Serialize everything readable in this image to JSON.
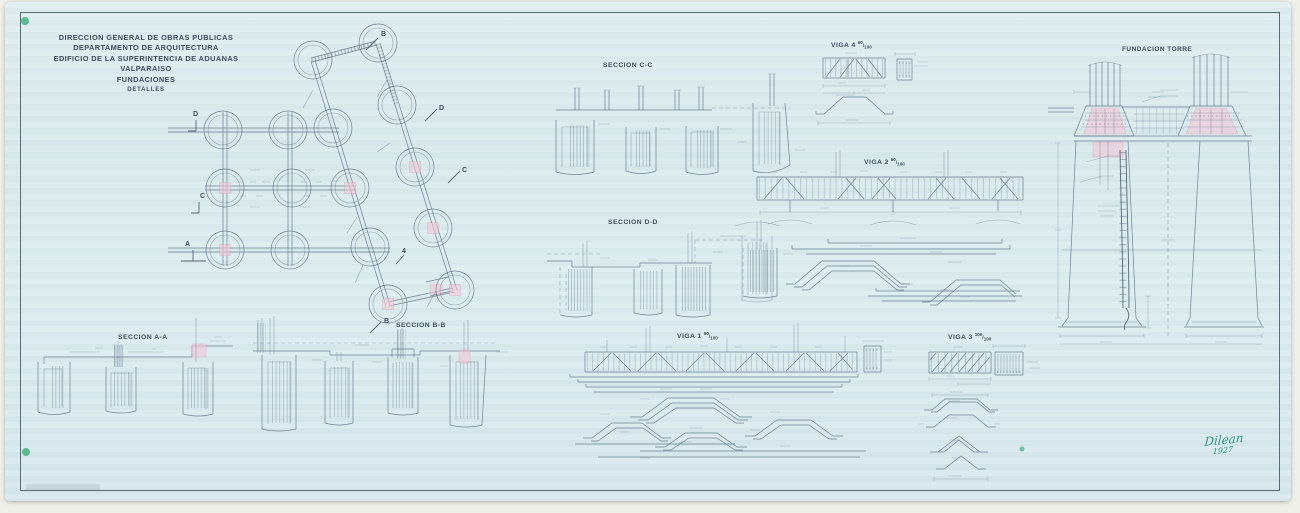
{
  "sheet": {
    "colors": {
      "paper": "#dcebee",
      "ink": "#3e4f5c",
      "line": "#5c7080",
      "pink": "#f2c8d7",
      "pink_line": "#d993b2",
      "green_dot": "#3fae7d",
      "signature_green": "#27987a"
    },
    "title_block": {
      "lines": [
        "DIRECCION GENERAL DE OBRAS PUBLICAS",
        "DEPARTAMENTO DE ARQUITECTURA",
        "EDIFICIO DE LA SUPERINTENCIA DE ADUANAS",
        "VALPARAISO",
        "FUNDACIONES",
        "DETALLES"
      ]
    },
    "section_labels": {
      "aa": "SECCION A-A",
      "bb": "SECCION B-B",
      "cc": "SECCION C-C",
      "dd": "SECCION D-D"
    },
    "beam_labels": {
      "viga1": {
        "name": "VIGA 1",
        "num": "60",
        "den": "100"
      },
      "viga2": {
        "name": "VIGA 2",
        "num": "60",
        "den": "100"
      },
      "viga3": {
        "name": "VIGA 3",
        "num": "100",
        "den": "100"
      },
      "viga4": {
        "name": "VIGA 4",
        "num": "60",
        "den": "100"
      }
    },
    "tower_label": "FUNDACION TORRE",
    "plan_markers": {
      "a": "A",
      "b": "B",
      "c": "C",
      "d": "D",
      "four": "4"
    },
    "signature": {
      "name": "Dilean",
      "year": "1927"
    }
  }
}
